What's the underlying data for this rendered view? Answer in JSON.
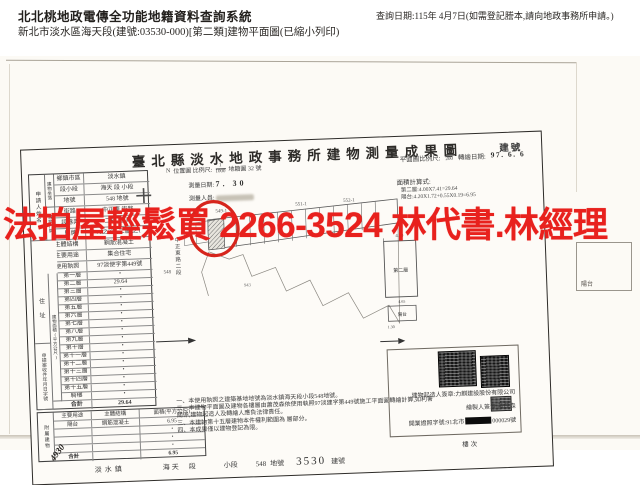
{
  "page": {
    "header": {
      "system_title": "北北桃地政電傳全功能地籍資料查詢系統",
      "document_line": "新北市淡水區海天段(建號:03530-000)[第二類]建物平面圖(已縮小列印)",
      "query_date": "查詢日期:115年 4月7日(如需登記謄本,請向地政事務所申請。)"
    },
    "overlay": {
      "ad_text": "法拍屋輕鬆買 2266-3524 林代書.林經理",
      "ad_color": "#e8211d"
    },
    "colors": {
      "annotation_red": "#d6251c",
      "paper": "#fcfaf5"
    }
  },
  "form": {
    "title": "臺北縣淡水地政事務所建物測量成果圖",
    "building_no_label": "建號",
    "applicant": {
      "name_label": "申請人姓名",
      "address_label": "住 址",
      "receipt_label": "申請案收件年月日字號",
      "receipt_handwriting": "4930"
    },
    "group_labels": {
      "location": "建物坐落",
      "doorplate": "建物門牌",
      "floor_area": "建物面積(平方公尺)",
      "attached": "附屬建物"
    },
    "basic_rows": [
      {
        "label": "鄉鎮市區",
        "value": "淡水鎮"
      },
      {
        "label": "段小段",
        "value": "海天 段 小段"
      },
      {
        "label": "地號",
        "value": "548 地號"
      },
      {
        "label": "街路",
        "value": "中正東 街路"
      },
      {
        "label": "段巷弄",
        "value": "二段 巷 弄"
      },
      {
        "label": "門牌",
        "value": "71之2號 二層 之1"
      },
      {
        "label": "主體結構",
        "value": "鋼筋混凝土"
      },
      {
        "label": "主要用途",
        "value": "集合住宅"
      },
      {
        "label": "使用執照",
        "value": "97淡使字第449號"
      }
    ],
    "floor_rows": [
      {
        "label": "第一層",
        "value": "・"
      },
      {
        "label": "第二層",
        "value": "29.64"
      },
      {
        "label": "第三層",
        "value": "・"
      },
      {
        "label": "第四層",
        "value": "・"
      },
      {
        "label": "第五層",
        "value": "・"
      },
      {
        "label": "第六層",
        "value": "・"
      },
      {
        "label": "第七層",
        "value": "・"
      },
      {
        "label": "第八層",
        "value": "・"
      },
      {
        "label": "第九層",
        "value": "・"
      },
      {
        "label": "第十層",
        "value": "・"
      },
      {
        "label": "第十一層",
        "value": "・"
      },
      {
        "label": "第十二層",
        "value": "・"
      },
      {
        "label": "第十三層",
        "value": "・"
      },
      {
        "label": "第十四層",
        "value": "・"
      },
      {
        "label": "第十五層",
        "value": "・"
      },
      {
        "label": "騎樓",
        "value": "・"
      }
    ],
    "floor_total": {
      "label": "合計",
      "value": "29.64"
    },
    "attached_table": {
      "headers": {
        "use": "主要用途",
        "structure": "主體結構",
        "area": "面積(平方公尺)"
      },
      "rows": [
        {
          "use": "陽台",
          "structure": "鋼筋混凝土",
          "area": "6.95"
        },
        {
          "use": "",
          "structure": "",
          "area": "・"
        },
        {
          "use": "",
          "structure": "",
          "area": "・"
        },
        {
          "use": "",
          "structure": "",
          "area": "・"
        }
      ],
      "total": {
        "label": "合計",
        "area": "6.95"
      }
    },
    "location_map": {
      "north_label": "N",
      "caption": "位置圖 比例尺:",
      "scale_num": "1",
      "scale_den": "1000",
      "sheet": "地籍圖 32 號",
      "survey_date_label": "測量日期:",
      "survey_date": "7. 30",
      "surveyor_label": "測量人員:",
      "street": "中正東路二段",
      "lot_labels": [
        "548-1",
        "549-1",
        "551-1",
        "552-1"
      ],
      "lot_main": "548",
      "lot_far": "943"
    },
    "plan": {
      "scale_label": "平面圖比例尺:",
      "scale_num": "1",
      "scale_den": "200",
      "draw_date_label": "轉繪日期:",
      "draw_date": "97. 6. 6",
      "calc_label": "面積計算式:",
      "calc_lines": [
        "第二層:4.00X7.41=29.64",
        "陽台:4.20X1.72+0.55X0.19=6.95"
      ],
      "floor_label": "第二層",
      "balcony_label": "陽台",
      "dims": {
        "top": "4.00",
        "middle": "4.65",
        "bottom": "1.30"
      }
    },
    "notes": [
      "一、本使用執照之建築基地地號為淡水鎮海天段小段548地號。",
      "二、本建物平面圖及建物各樓層由蕭茂森依使用執照97淡建字第449號施工平面圖轉繪計算,如利害關係,建物起造人及轉繪人應負法律責任。",
      "三、本建物第十五層建物本件權利範圍為 層部分。",
      "四、本成果僅以建物登記為限。"
    ],
    "signature": {
      "builder_label": "建物起造人簽章:",
      "builder_value": "力麒建設股份有限公司",
      "drafter_label": "繪製人簽章:",
      "drafter_value": "蕭茂森",
      "license_label": "開業證照字號:",
      "license_prefix": "91北市",
      "license_suffix": "000029號",
      "floor_seq_label": "樓次"
    },
    "footer": {
      "town": "淡水鎮",
      "section": "海天",
      "section_label": "段",
      "subsection": "小段",
      "lot": "548",
      "lot_label": "地號",
      "building_no": "3530",
      "building_no_label": "建號"
    },
    "stray_balcony_label": "陽台"
  }
}
